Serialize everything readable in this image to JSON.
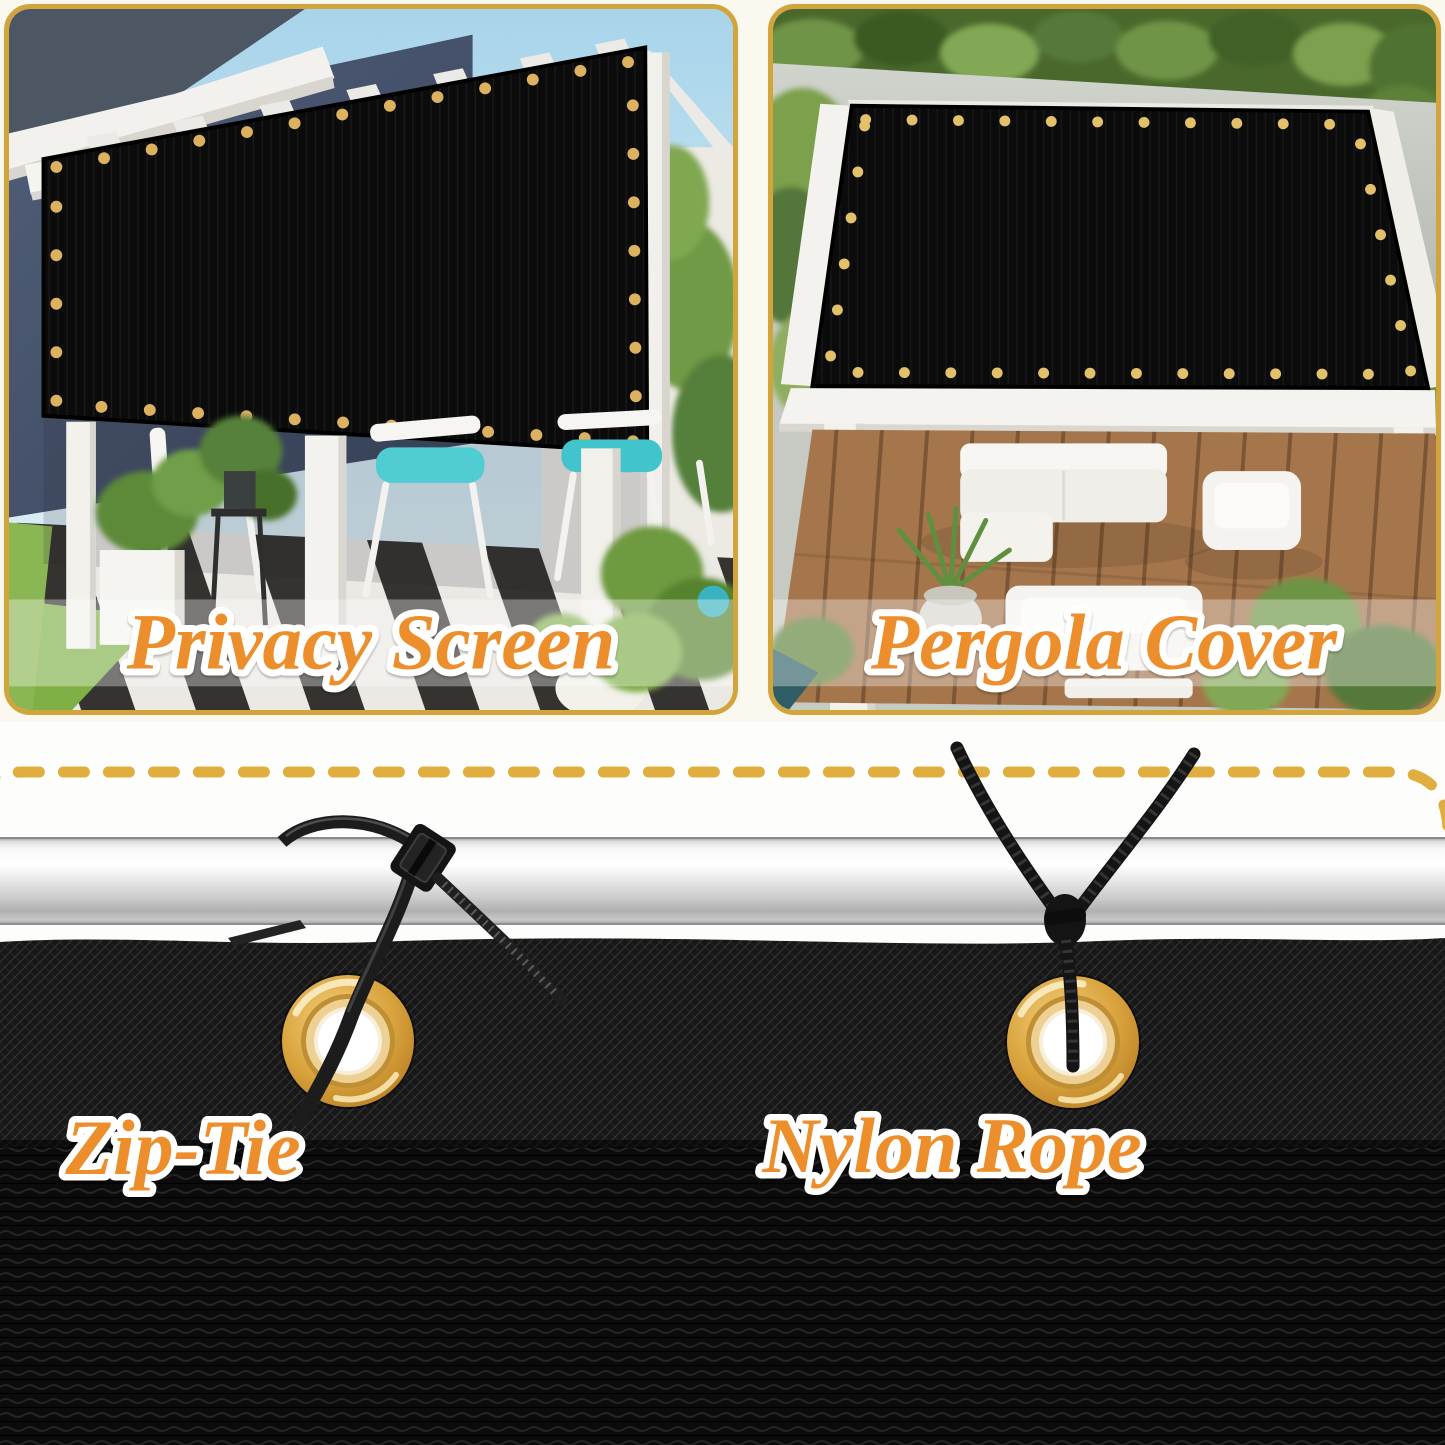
{
  "palette": {
    "background_cream": "#FBF8EF",
    "section_white": "#FDFDFB",
    "gold_border": "#D2A53C",
    "dash_gold": "#DFAE3E",
    "label_orange": "#ED8E2D",
    "label_outline": "#FFFFFF",
    "mesh_black": "#0C0C0C",
    "grommet_gold": "#D9A33C",
    "pole_silver": "#DCDCDC",
    "cushion_teal": "#41C4CB",
    "grass_green": "#7FB046",
    "deck_brown": "#A5764C",
    "sky_blue": "#AFD9EC",
    "wall_navy": "#46536B",
    "pergola_white": "#F3F2EE",
    "foliage_green": "#6E9A40"
  },
  "panels": [
    {
      "name": "privacy-screen",
      "label": "Privacy Screen"
    },
    {
      "name": "pergola-cover",
      "label": "Pergola Cover"
    }
  ],
  "installation_methods": [
    {
      "name": "zip-tie",
      "label": "Zip-Tie"
    },
    {
      "name": "nylon-rope",
      "label": "Nylon Rope"
    }
  ]
}
